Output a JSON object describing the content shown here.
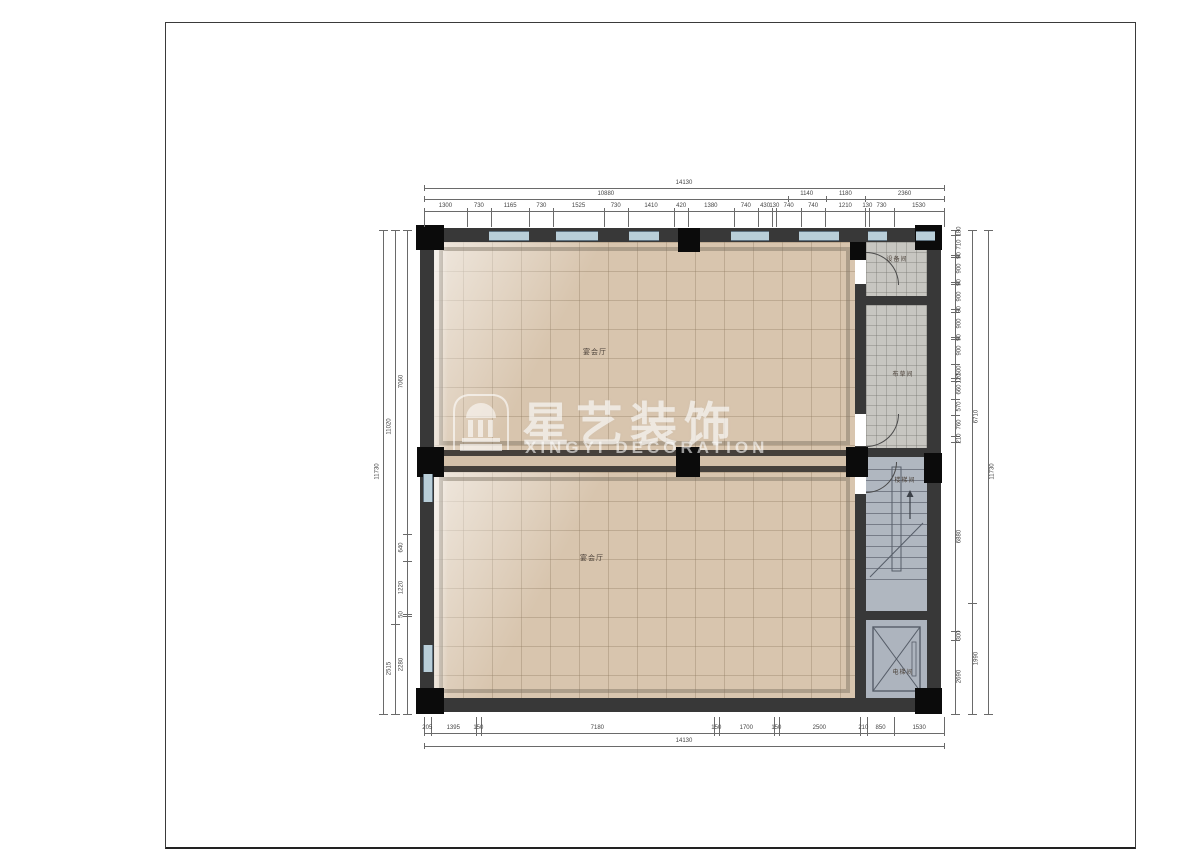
{
  "watermark": {
    "brand": "星艺装饰",
    "subtitle": "XINGYI DECORATION"
  },
  "rooms": {
    "hall_upper": "宴会厅",
    "hall_lower": "宴会厅",
    "equipment": "设备间",
    "linen": "布草间",
    "stair": "楼梯间",
    "elevator": "电梯间"
  },
  "dimensions": {
    "top_total": "14130",
    "top_groups": [
      "10880",
      "1140",
      "1180",
      "2360"
    ],
    "top_detail": [
      "1300",
      "730",
      "1165",
      "730",
      "1525",
      "730",
      "1410",
      "420",
      "1380",
      "740",
      "430",
      "130",
      "740",
      "740",
      "1210",
      "130",
      "730",
      "1530"
    ],
    "bottom_detail": [
      "205",
      "1395",
      "150",
      "7180",
      "150",
      "1700",
      "150",
      "2500",
      "210",
      "850",
      "1530"
    ],
    "bottom_total": "14130",
    "left_outer": "11730",
    "left_groups": [
      "11020",
      "2515"
    ],
    "left_detail": [
      "7060",
      "640",
      "1220",
      "50",
      "2280"
    ],
    "right_detail": [
      "180",
      "710",
      "90",
      "900",
      "90",
      "900",
      "90",
      "900",
      "90",
      "900",
      "500",
      "120",
      "660",
      "570",
      "760",
      "210",
      "6880",
      "300",
      "2690"
    ],
    "right_groups": [
      "6710",
      "1990"
    ],
    "right_outer": "11730"
  },
  "colors": {
    "wall": "#383838",
    "column": "#0b0b0b",
    "window": "#b9ced8",
    "hall_floor": "#d8c5ae",
    "service_floor": "#c7c6c1",
    "stair_floor": "#b0b7c0",
    "dimension_text": "#444444"
  }
}
